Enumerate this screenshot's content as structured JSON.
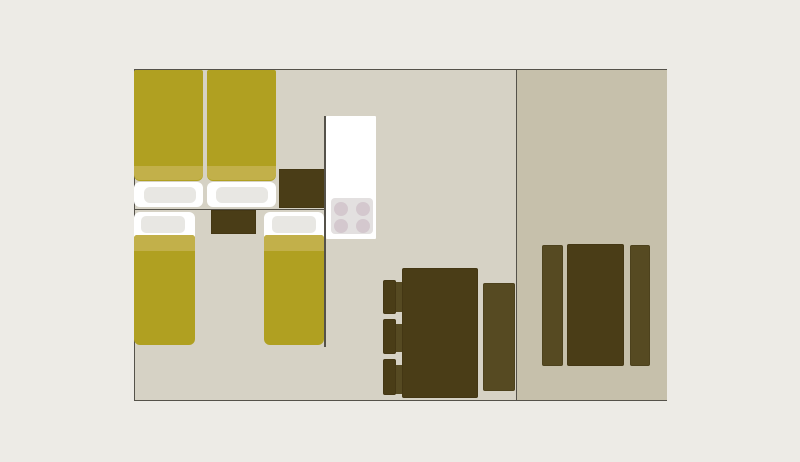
{
  "palette": {
    "page_bg": "#edebe6",
    "wall_line": "#55524a",
    "floor_main": "#d6d2c5",
    "floor_annex": "#c6c0ab",
    "bedding": "#b0a021",
    "bedding_fold": "#c2b04a",
    "linen": "#ffffff",
    "pillow": "#e8e7e3",
    "wood_dark": "#4a3d17",
    "wood_mid": "#564a22",
    "counter": "#ffffff",
    "hob": "#e3e0e0",
    "burner": "#d4c8ce"
  },
  "floorplan": {
    "plan": {
      "x": 133.5,
      "y": 69,
      "w": 533.5,
      "h": 331.5
    },
    "main_room": {
      "x": 0,
      "y": 0,
      "w": 383,
      "h": 331.5
    },
    "annex_room": {
      "x": 383,
      "y": 0,
      "w": 150.5,
      "h": 331.5
    },
    "items": [
      {
        "name": "double-bed-left-base",
        "x": 0.5,
        "y": 112.5,
        "w": 69,
        "h": 25.5,
        "fill": "linen",
        "r": "6px"
      },
      {
        "name": "double-bed-right-base",
        "x": 73,
        "y": 112.5,
        "w": 69,
        "h": 25.5,
        "fill": "linen",
        "r": "6px"
      },
      {
        "name": "double-bed-left-pillow",
        "x": 10,
        "y": 117.5,
        "w": 52,
        "h": 16,
        "fill": "pillow",
        "r": "6px"
      },
      {
        "name": "double-bed-right-pillow",
        "x": 82,
        "y": 117.5,
        "w": 52.5,
        "h": 16,
        "fill": "pillow",
        "r": "6px"
      },
      {
        "name": "double-bed-left-cover",
        "x": 0.5,
        "y": 0.5,
        "w": 69,
        "h": 111,
        "fill": "bedding",
        "r": "2px 2px 6px 6px"
      },
      {
        "name": "double-bed-right-cover",
        "x": 73,
        "y": 0.5,
        "w": 69,
        "h": 111,
        "fill": "bedding",
        "r": "2px 2px 6px 6px"
      },
      {
        "name": "double-bed-left-cover-fold",
        "x": 0.5,
        "y": 96.5,
        "w": 69,
        "h": 14.5,
        "fill": "bedding_fold",
        "r": "0 0 6px 6px"
      },
      {
        "name": "double-bed-right-cover-fold",
        "x": 73,
        "y": 96.5,
        "w": 69,
        "h": 14.5,
        "fill": "bedding_fold",
        "r": "0 0 6px 6px"
      },
      {
        "name": "single-bed-left-base",
        "x": 0.5,
        "y": 142.5,
        "w": 61,
        "h": 50,
        "fill": "linen",
        "r": "6px"
      },
      {
        "name": "single-bed-left-pillow",
        "x": 7.5,
        "y": 147,
        "w": 44,
        "h": 17,
        "fill": "pillow",
        "r": "5px"
      },
      {
        "name": "single-bed-left-cover",
        "x": 0.5,
        "y": 165.5,
        "w": 60.5,
        "h": 110,
        "fill": "bedding",
        "r": "3px 3px 6px 6px"
      },
      {
        "name": "single-bed-left-cover-fold",
        "x": 0.5,
        "y": 165.5,
        "w": 60.5,
        "h": 16,
        "fill": "bedding_fold",
        "r": "3px 3px 0 0"
      },
      {
        "name": "single-bed-right-base",
        "x": 130,
        "y": 142.5,
        "w": 60.5,
        "h": 50,
        "fill": "linen",
        "r": "6px"
      },
      {
        "name": "single-bed-right-pillow",
        "x": 138,
        "y": 147,
        "w": 44,
        "h": 17,
        "fill": "pillow",
        "r": "5px"
      },
      {
        "name": "single-bed-right-cover",
        "x": 130.5,
        "y": 165.5,
        "w": 59.5,
        "h": 110,
        "fill": "bedding",
        "r": "3px 3px 6px 6px"
      },
      {
        "name": "single-bed-right-cover-fold",
        "x": 130.5,
        "y": 165.5,
        "w": 59.5,
        "h": 16,
        "fill": "bedding_fold",
        "r": "3px 3px 0 0"
      },
      {
        "name": "nightstand-double-bed",
        "x": 145,
        "y": 100,
        "w": 46,
        "h": 39,
        "fill": "wood_dark",
        "r": "0",
        "outline": true
      },
      {
        "name": "nightstand-single-beds",
        "x": 77,
        "y": 140.5,
        "w": 45,
        "h": 24,
        "fill": "wood_dark",
        "r": "0",
        "outline": true
      },
      {
        "name": "bedroom-wall-horizontal",
        "x": 0,
        "y": 139.5,
        "w": 191,
        "h": 1.5,
        "fill": "wall_line",
        "r": "0"
      },
      {
        "name": "bedroom-wall-vertical",
        "x": 190.5,
        "y": 46.5,
        "w": 1.5,
        "h": 231,
        "fill": "wall_line",
        "r": "0"
      },
      {
        "name": "kitchen-counter",
        "x": 192.5,
        "y": 46.5,
        "w": 50,
        "h": 123.5,
        "fill": "counter",
        "r": "1px"
      },
      {
        "name": "stove-hob",
        "x": 197,
        "y": 128.5,
        "w": 42.5,
        "h": 36.5,
        "fill": "hob",
        "r": "4px",
        "burners": {
          "d": 14,
          "centers": [
            [
              10.5,
              11.5
            ],
            [
              32.5,
              11.5
            ],
            [
              10.5,
              28.5
            ],
            [
              32.5,
              28.5
            ]
          ]
        }
      },
      {
        "name": "dining-chair-1-seat",
        "x": 261,
        "y": 213,
        "w": 8.5,
        "h": 30,
        "fill": "wood_mid",
        "r": "1px"
      },
      {
        "name": "dining-chair-2-seat",
        "x": 261,
        "y": 254.5,
        "w": 8.5,
        "h": 28.5,
        "fill": "wood_mid",
        "r": "1px"
      },
      {
        "name": "dining-chair-3-seat",
        "x": 261,
        "y": 295.5,
        "w": 8.5,
        "h": 29,
        "fill": "wood_mid",
        "r": "1px"
      },
      {
        "name": "dining-chair-1-back",
        "x": 249,
        "y": 210.5,
        "w": 13,
        "h": 34,
        "fill": "wood_dark",
        "r": "2px",
        "outline": true
      },
      {
        "name": "dining-chair-2-back",
        "x": 249,
        "y": 249.5,
        "w": 13,
        "h": 35,
        "fill": "wood_dark",
        "r": "2px",
        "outline": true
      },
      {
        "name": "dining-chair-3-back",
        "x": 249,
        "y": 290,
        "w": 13,
        "h": 36,
        "fill": "wood_dark",
        "r": "2px",
        "outline": true
      },
      {
        "name": "dining-table",
        "x": 268,
        "y": 198.5,
        "w": 76.5,
        "h": 130.5,
        "fill": "wood_dark",
        "r": "2px",
        "outline": true
      },
      {
        "name": "dining-bench",
        "x": 349.5,
        "y": 213.5,
        "w": 32,
        "h": 108.5,
        "fill": "wood_mid",
        "r": "2px",
        "outline": true
      },
      {
        "name": "annex-bench-left",
        "x": 408,
        "y": 176,
        "w": 21.5,
        "h": 120.5,
        "fill": "wood_mid",
        "r": "2px",
        "outline": true
      },
      {
        "name": "annex-table",
        "x": 433,
        "y": 175,
        "w": 57,
        "h": 121.5,
        "fill": "wood_dark",
        "r": "2px",
        "outline": true
      },
      {
        "name": "annex-bench-right",
        "x": 496,
        "y": 176,
        "w": 20,
        "h": 120.5,
        "fill": "wood_mid",
        "r": "2px",
        "outline": true
      }
    ]
  }
}
